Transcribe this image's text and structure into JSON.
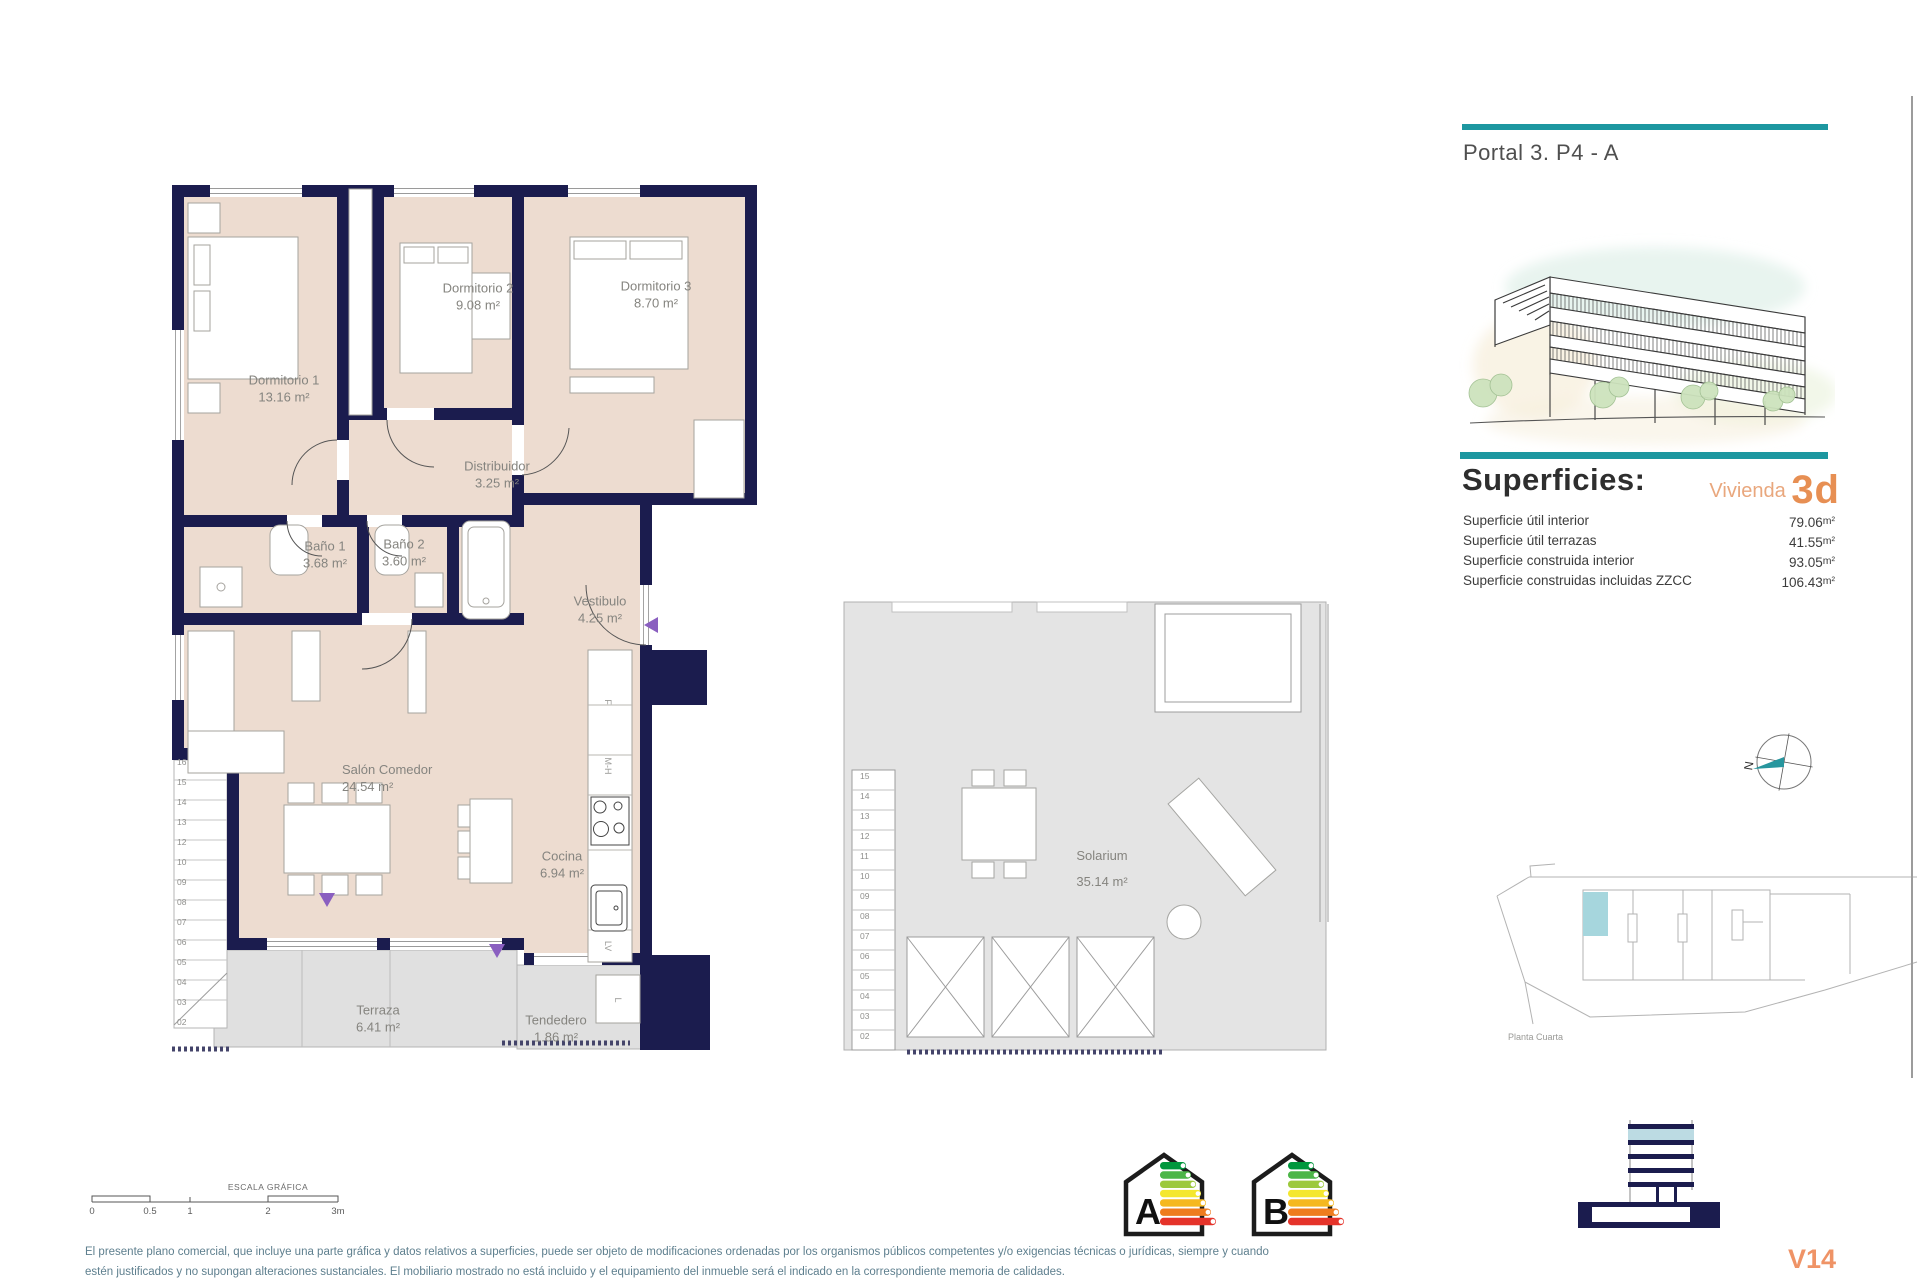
{
  "header": {
    "title": "Portal 3. P4 - A"
  },
  "superficies": {
    "heading": "Superficies:",
    "vivienda_label": "Vivienda",
    "vivienda_value": "3d",
    "rows": [
      {
        "label": "Superficie útil interior",
        "value": "79.06",
        "unit": "m²"
      },
      {
        "label": "Superficie útil terrazas",
        "value": "41.55",
        "unit": "m²"
      },
      {
        "label": "Superficie construida interior",
        "value": "93.05",
        "unit": "m²"
      },
      {
        "label": "Superficie construidas incluidas ZZCC",
        "value": "106.43",
        "unit": "m²"
      }
    ]
  },
  "floor_plan": {
    "rooms": [
      {
        "name": "Dormitorio 1",
        "area": "13.16 m²"
      },
      {
        "name": "Dormitorio 2",
        "area": "9.08 m²"
      },
      {
        "name": "Dormitorio 3",
        "area": "8.70 m²"
      },
      {
        "name": "Distribuidor",
        "area": "3.25 m²"
      },
      {
        "name": "Baño 1",
        "area": "3.68 m²"
      },
      {
        "name": "Baño 2",
        "area": "3.60 m²"
      },
      {
        "name": "Vestibulo",
        "area": "4.25 m²"
      },
      {
        "name": "Salón Comedor",
        "area": "24.54 m²"
      },
      {
        "name": "Cocina",
        "area": "6.94 m²"
      },
      {
        "name": "Terraza",
        "area": "6.41 m²"
      },
      {
        "name": "Tendedero",
        "area": "1.86 m²"
      }
    ],
    "stair_numbers_upper": "16\n15\n14\n13\n12",
    "stair_numbers_lower": "10\n09\n08\n07\n06\n05\n04\n03\n02",
    "appliances": {
      "fridge": "F",
      "oven": "M-H",
      "dishwasher": "LV",
      "washer": "L"
    }
  },
  "solarium": {
    "name": "Solarium",
    "area": "35.14 m²",
    "stair_numbers": "15\n14\n13\n12\n11\n10\n09\n08\n07\n06\n05\n04\n03\n02"
  },
  "site_plan": {
    "caption": "Planta Cuarta"
  },
  "compass": {
    "north": "N"
  },
  "scale_bar": {
    "title": "ESCALA GRÁFICA",
    "ticks": [
      "0",
      "0.5",
      "1",
      "2",
      "3m"
    ]
  },
  "energy": {
    "ratings": [
      "A",
      "B"
    ]
  },
  "footer": {
    "disclaimer_line1": "El presente plano comercial, que incluye una parte gráfica y datos relativos a superficies, puede ser objeto de modificaciones ordenadas por los organismos públicos competentes y/o exigencias técnicas o jurídicas, siempre y cuando",
    "disclaimer_line2": "estén justificados y no supongan alteraciones sustanciales. El mobiliario mostrado no está incluido y el equipamiento del inmueble será el indicado en la correspondiente memoria de calidades.",
    "version": "V14"
  }
}
